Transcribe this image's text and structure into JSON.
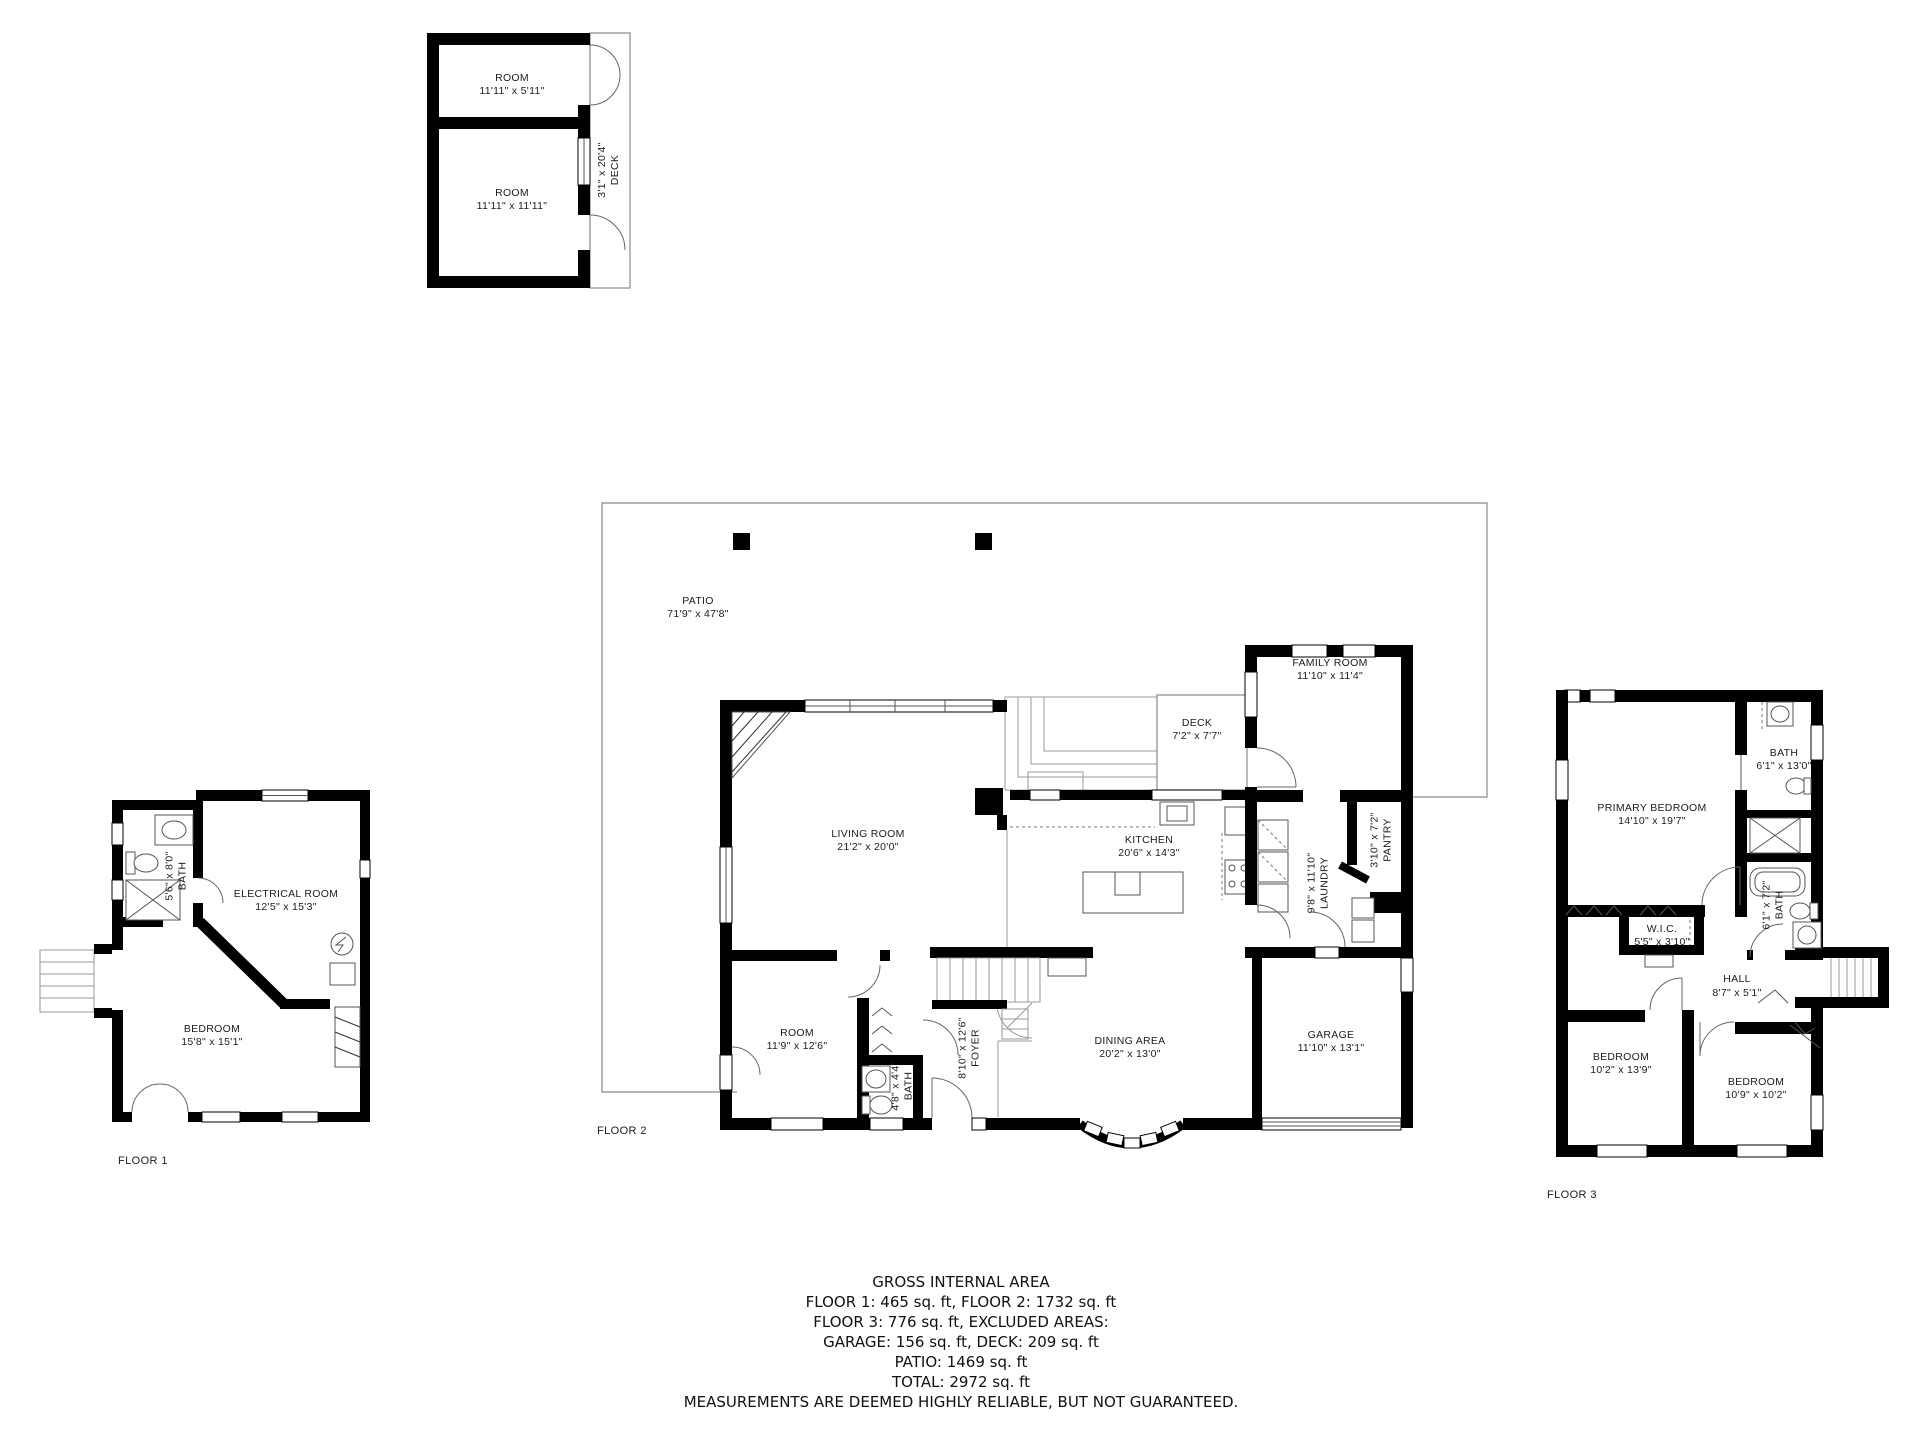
{
  "top_plan": {
    "room1": {
      "name": "ROOM",
      "dims": "11'11\" x 5'11\""
    },
    "room2": {
      "name": "ROOM",
      "dims": "11'11\" x 11'11\""
    },
    "deck": {
      "name": "DECK",
      "dims": "3'1\" x 20'4\""
    }
  },
  "floor1": {
    "label": "FLOOR 1",
    "bath": {
      "name": "BATH",
      "dims": "5'6\" x 8'0\""
    },
    "electrical": {
      "name": "ELECTRICAL ROOM",
      "dims": "12'5\" x 15'3\""
    },
    "bedroom": {
      "name": "BEDROOM",
      "dims": "15'8\" x 15'1\""
    }
  },
  "floor2": {
    "label": "FLOOR 2",
    "patio": {
      "name": "PATIO",
      "dims": "71'9\" x 47'8\""
    },
    "living": {
      "name": "LIVING ROOM",
      "dims": "21'2\" x 20'0\""
    },
    "deck": {
      "name": "DECK",
      "dims": "7'2\" x 7'7\""
    },
    "family": {
      "name": "FAMILY ROOM",
      "dims": "11'10\" x 11'4\""
    },
    "kitchen": {
      "name": "KITCHEN",
      "dims": "20'6\" x 14'3\""
    },
    "pantry": {
      "name": "PANTRY",
      "dims": "3'10\" x 7'2\""
    },
    "laundry": {
      "name": "LAUNDRY",
      "dims": "9'8\" x 11'10\""
    },
    "room": {
      "name": "ROOM",
      "dims": "11'9\" x 12'6\""
    },
    "foyer": {
      "name": "FOYER",
      "dims": "8'10\" x 12'6\""
    },
    "bath": {
      "name": "BATH",
      "dims": "4'8\" x 4'4\""
    },
    "dining": {
      "name": "DINING AREA",
      "dims": "20'2\" x 13'0\""
    },
    "garage": {
      "name": "GARAGE",
      "dims": "11'10\" x 13'1\""
    }
  },
  "floor3": {
    "label": "FLOOR 3",
    "primary": {
      "name": "PRIMARY BEDROOM",
      "dims": "14'10\" x 19'7\""
    },
    "bath_top": {
      "name": "BATH",
      "dims": "6'1\" x 13'0\""
    },
    "bath_lower": {
      "name": "BATH",
      "dims": "6'1\" x 7'2\""
    },
    "wic": {
      "name": "W.I.C.",
      "dims": "5'5\" x 3'10\""
    },
    "hall": {
      "name": "HALL",
      "dims": "8'7\" x 5'1\""
    },
    "bedroom_left": {
      "name": "BEDROOM",
      "dims": "10'2\" x 13'9\""
    },
    "bedroom_right": {
      "name": "BEDROOM",
      "dims": "10'9\" x 10'2\""
    }
  },
  "summary": {
    "title": "GROSS INTERNAL AREA",
    "lines": [
      "FLOOR 1: 465 sq. ft, FLOOR 2: 1732 sq. ft",
      "FLOOR 3: 776 sq. ft, EXCLUDED AREAS:",
      "GARAGE: 156 sq. ft, DECK: 209 sq. ft",
      "PATIO: 1469 sq. ft",
      "TOTAL: 2972 sq. ft"
    ],
    "disclaimer": "MEASUREMENTS ARE DEEMED HIGHLY RELIABLE, BUT NOT GUARANTEED."
  }
}
